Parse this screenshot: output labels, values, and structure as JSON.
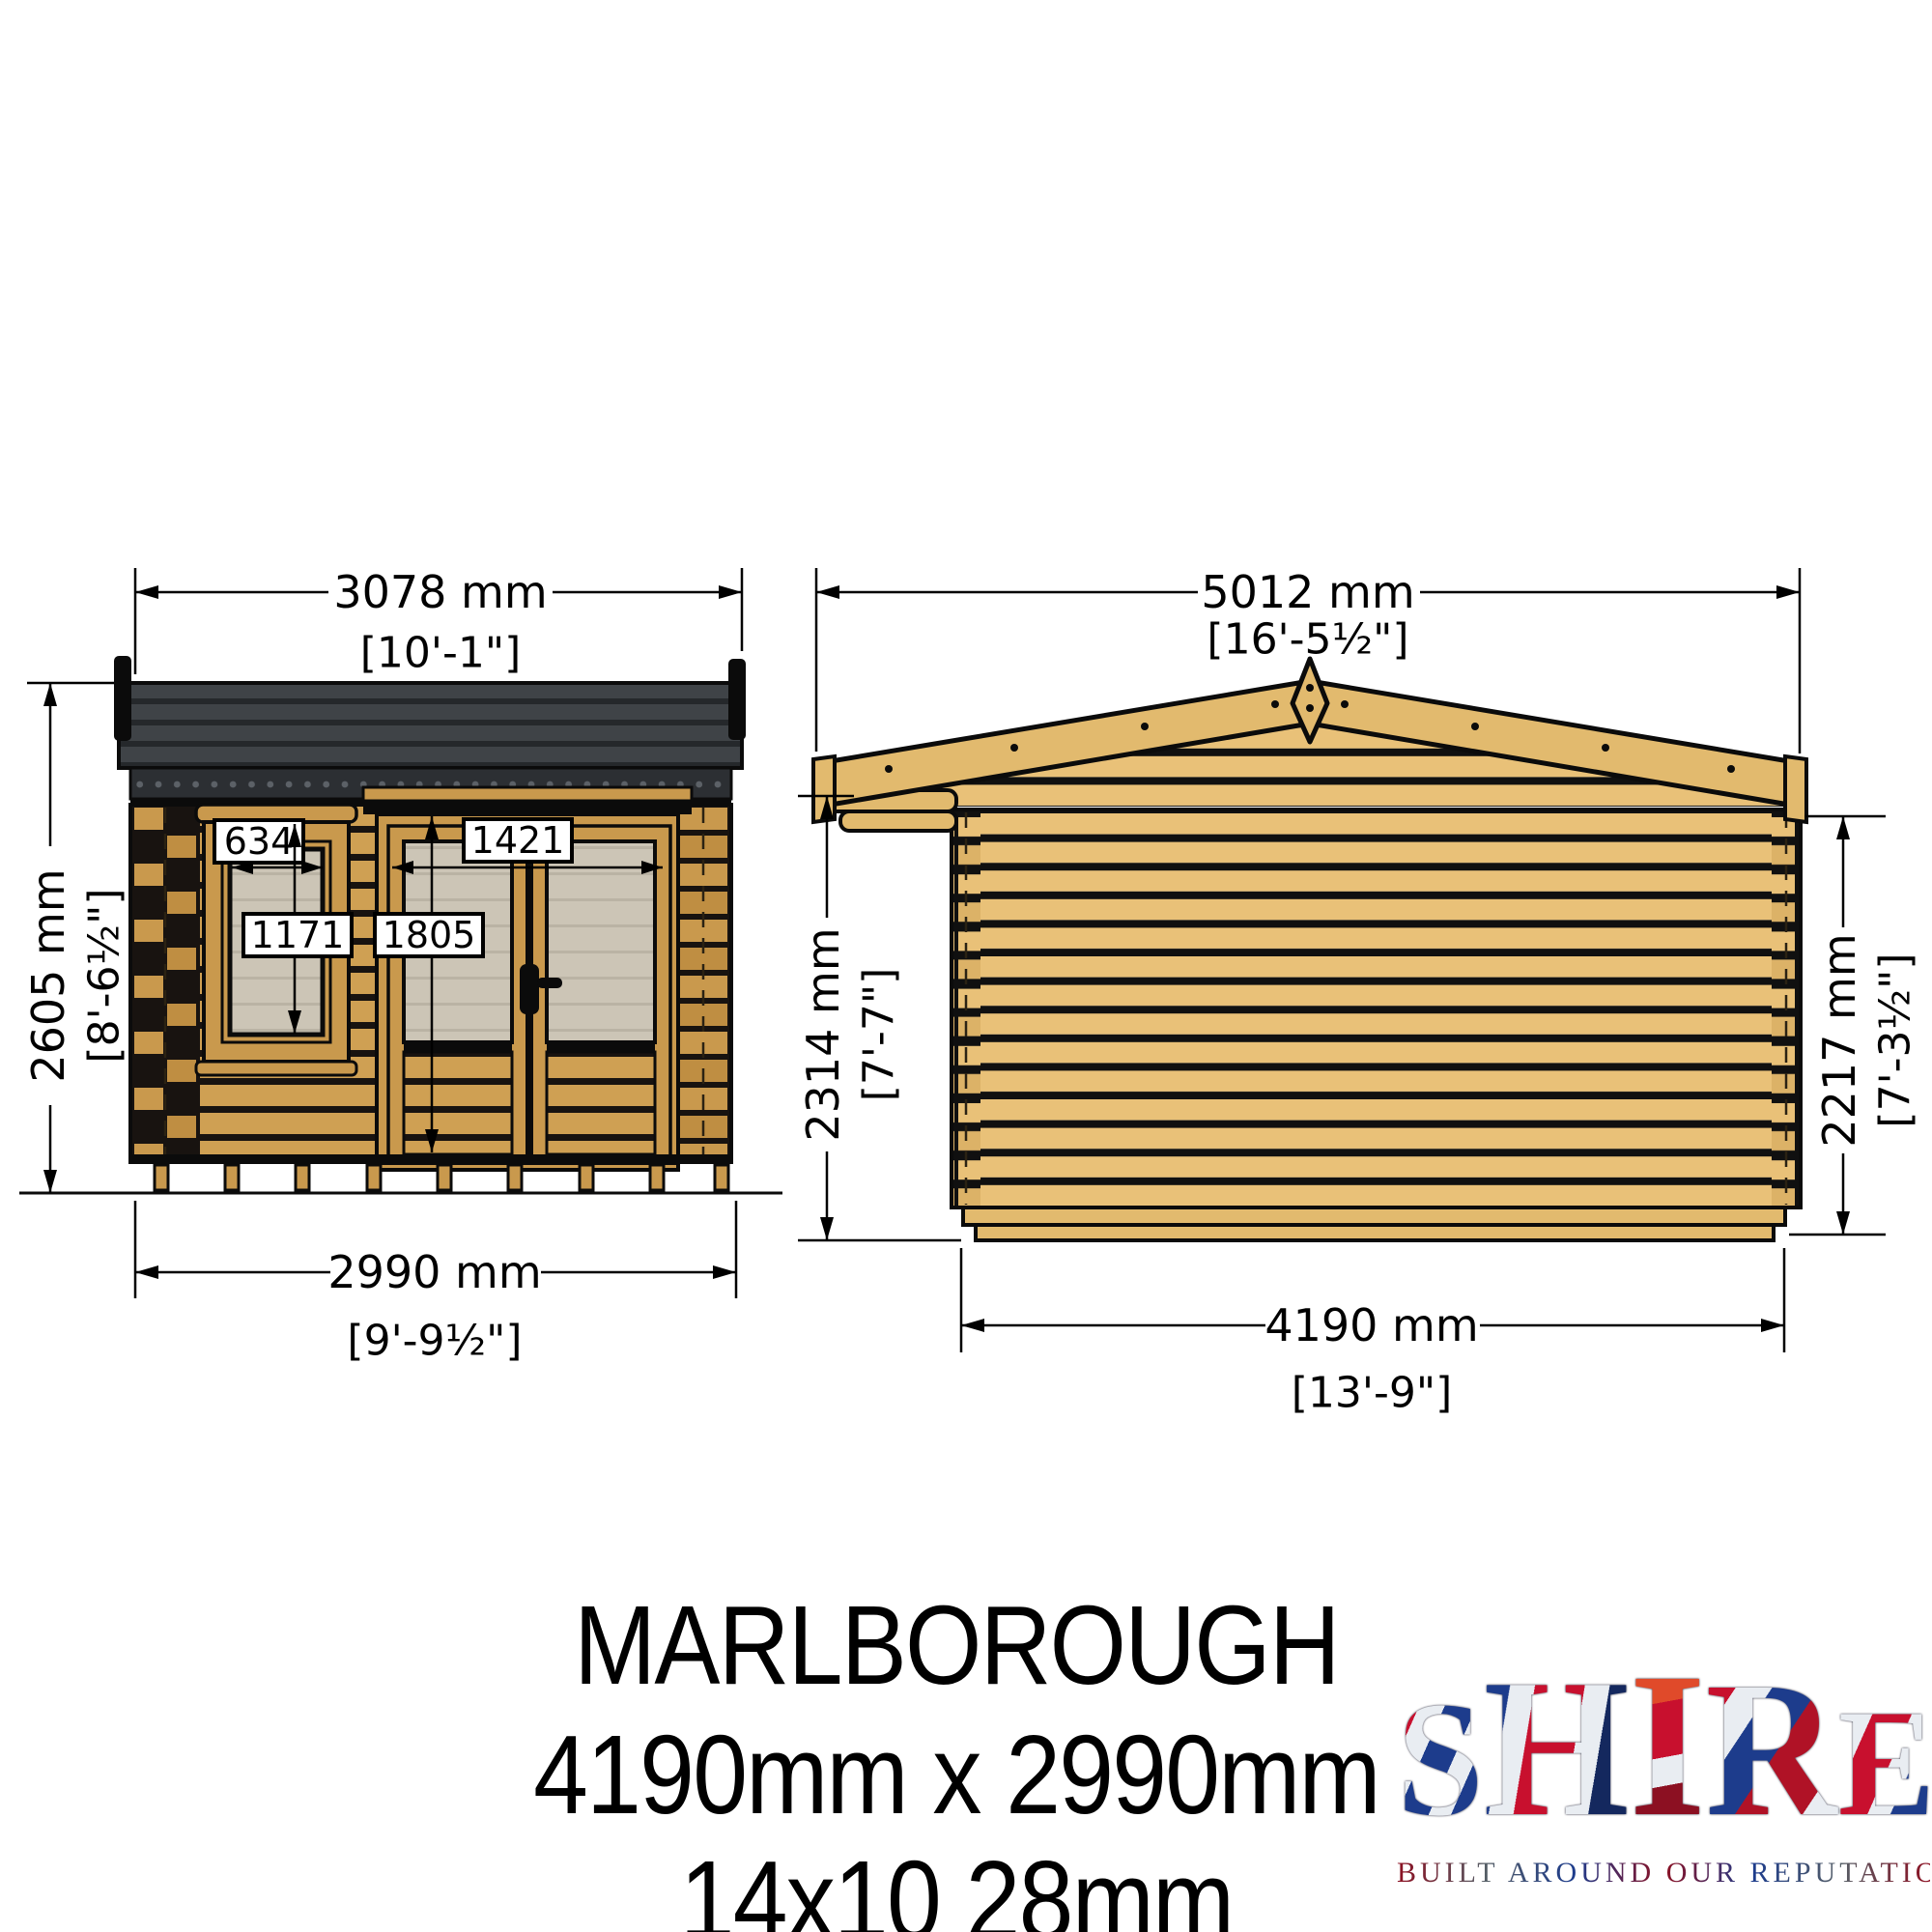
{
  "drawing": {
    "front_elevation": {
      "width_dim": {
        "mm": "3078 mm",
        "ft": "[10'-1\"]"
      },
      "height_dim": {
        "mm": "2605 mm",
        "ft": "[8'-6½\"]"
      },
      "base_dim": {
        "mm": "2990 mm",
        "ft": "[9'-9½\"]"
      },
      "window": {
        "width": "634",
        "height": "1171"
      },
      "door": {
        "width": "1421",
        "height": "1805"
      }
    },
    "side_elevation": {
      "width_dim": {
        "mm": "5012 mm",
        "ft": "[16'-5½\"]"
      },
      "front_height_dim": {
        "mm": "2314 mm",
        "ft": "[7'-7\"]"
      },
      "rear_height_dim": {
        "mm": "2217 mm",
        "ft": "[7'-3½\"]"
      },
      "base_dim": {
        "mm": "4190 mm",
        "ft": "[13'-9\"]"
      }
    }
  },
  "title": {
    "name": "MARLBOROUGH",
    "dimensions": "4190mm x 2990mm",
    "spec": "14x10 28mm"
  },
  "logo": {
    "letters": [
      "S",
      "H",
      "I",
      "R",
      "E"
    ],
    "tagline": "BUILT AROUND OUR REPUTATION"
  },
  "colors": {
    "wood_front": "#cfa053",
    "wood_side": "#e9c178",
    "roof_felt": "#3f4347",
    "glazing": "#ccc5b6",
    "outline": "#0b0b0b",
    "logo_red": "#c8102e",
    "logo_blue": "#1d3c8c"
  }
}
